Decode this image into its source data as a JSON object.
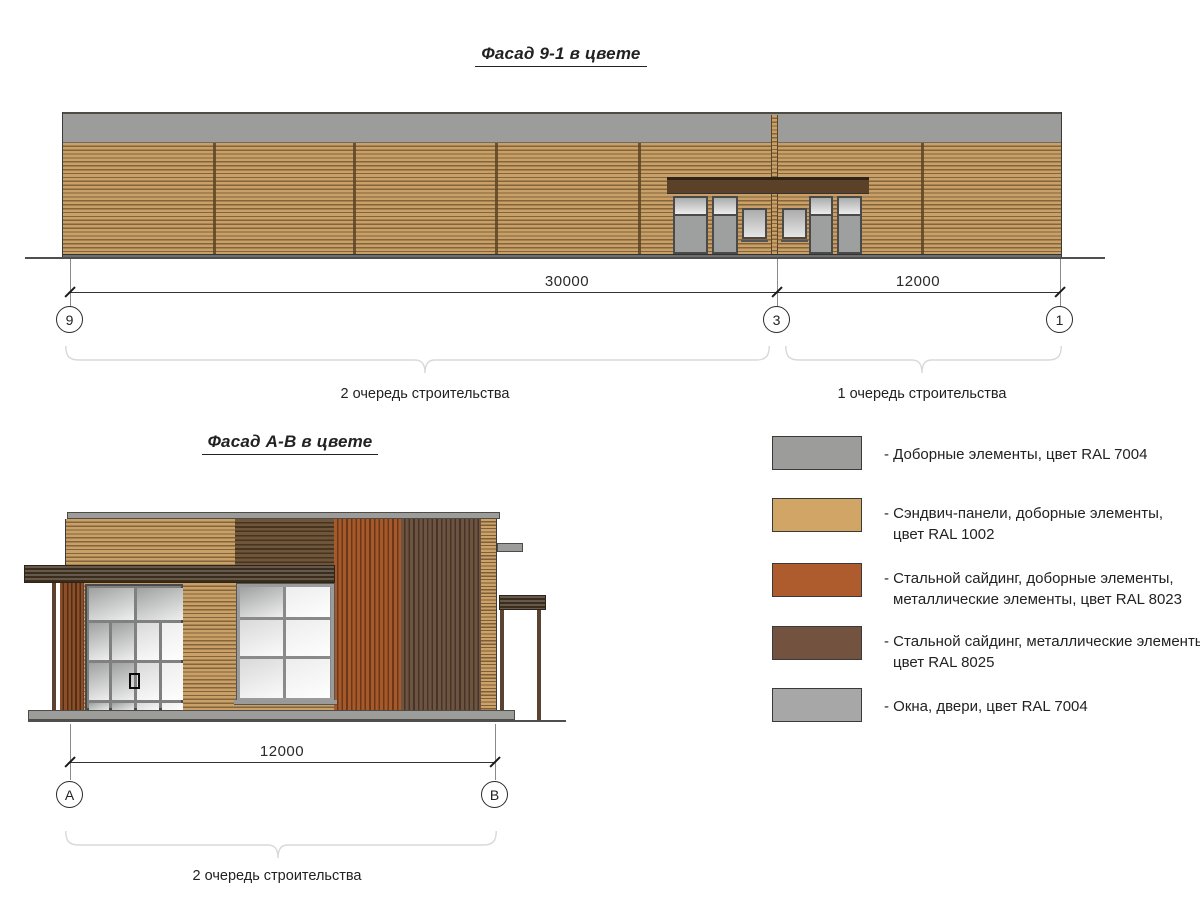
{
  "titles": {
    "facade91": "Фасад 9-1 в цвете",
    "facadeAB": "Фасад А-В в цвете"
  },
  "facade91": {
    "dim_left": "30000",
    "dim_right": "12000",
    "grid_left": "9",
    "grid_middle": "3",
    "grid_right": "1",
    "phase_left": "2 очередь строительства",
    "phase_right": "1 очередь строительства"
  },
  "facadeAB": {
    "dim": "12000",
    "grid_left": "А",
    "grid_right": "В",
    "phase": "2 очередь строительства"
  },
  "legend": {
    "items": [
      {
        "color": "#9C9C9A",
        "lines": [
          "- Доборные элементы, цвет RAL 7004"
        ]
      },
      {
        "color": "#D0A565",
        "lines": [
          "- Сэндвич-панели, доборные элементы,",
          "цвет RAL 1002"
        ]
      },
      {
        "color": "#AE5C2D",
        "lines": [
          "- Стальной сайдинг, доборные элементы,",
          "металлические элементы, цвет RAL 8023"
        ]
      },
      {
        "color": "#73533F",
        "lines": [
          "- Стальной сайдинг, металлические элементы,",
          "цвет RAL 8025"
        ]
      },
      {
        "color": "#A7A7A7",
        "lines": [
          "- Окна, двери, цвет RAL 7004"
        ]
      }
    ]
  }
}
